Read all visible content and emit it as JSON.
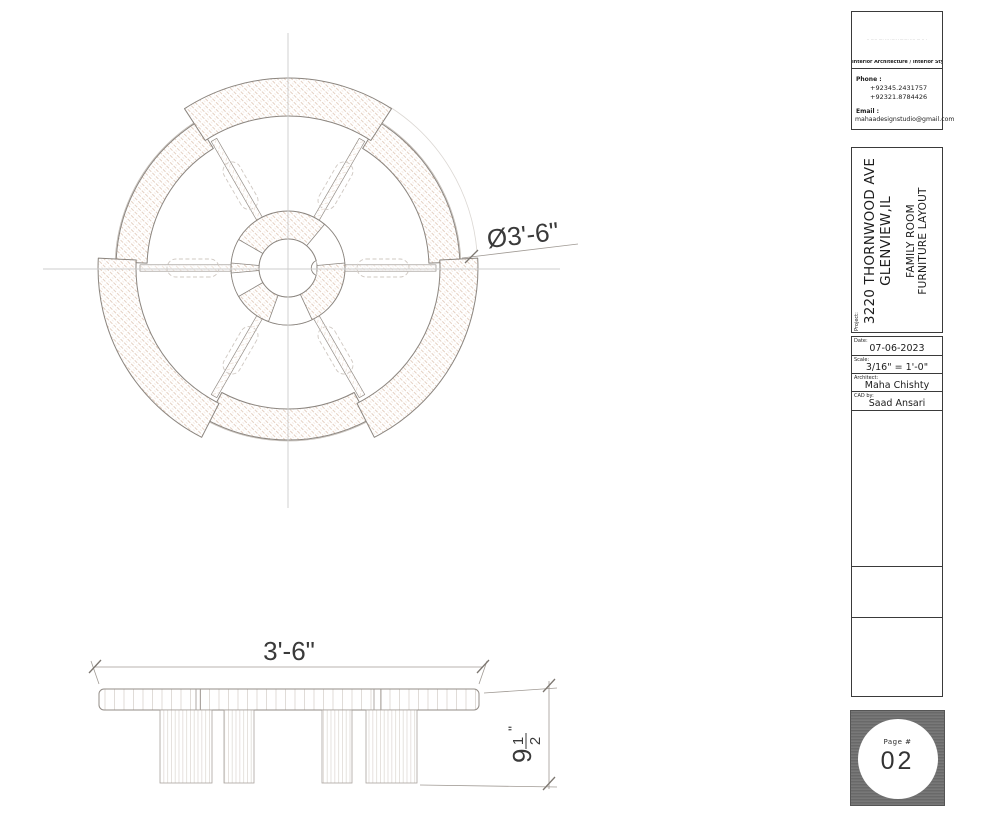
{
  "sheet": {
    "plan": {
      "diameter_label": "Ø3'-6\""
    },
    "elevation": {
      "width_label": "3'-6\"",
      "height_whole": "9",
      "height_numerator": "1",
      "height_denominator": "2",
      "height_unit": "\""
    },
    "title_block": {
      "tagline": "·· ····· ···· ··· ····· ········ ···· ··· ·· ·",
      "services": "Interior Architecture / Interior Styling/ Furniture",
      "phone_label": "Phone :",
      "phone_1": "+92345.2431757",
      "phone_2": "+92321.8784426",
      "email_label": "Email :",
      "email": "mahaadesignstudio@gmail.com",
      "project_label": "Project:",
      "address_line1": "3220 THORNWOOD AVE",
      "address_line2": "GLENVIEW,IL",
      "drawing_title_line1": "FAMILY ROOM",
      "drawing_title_line2": "FURNITURE LAYOUT",
      "meta": {
        "rows": [
          {
            "label": "Date:",
            "value": "07-06-2023"
          },
          {
            "label": "Scale:",
            "value": "3/16\" = 1'-0\""
          },
          {
            "label": "Architect:",
            "value": "Maha Chishty"
          },
          {
            "label": "CAD by:",
            "value": "Saad Ansari"
          }
        ]
      },
      "page_label": "Page #",
      "page_number": "02"
    },
    "colors": {
      "hatch": "#e2cbbb",
      "outline": "#8b857f",
      "centerline": "#cdcdcd",
      "dim_text": "#3a3a3a",
      "page_box_gray": "#707070"
    }
  }
}
